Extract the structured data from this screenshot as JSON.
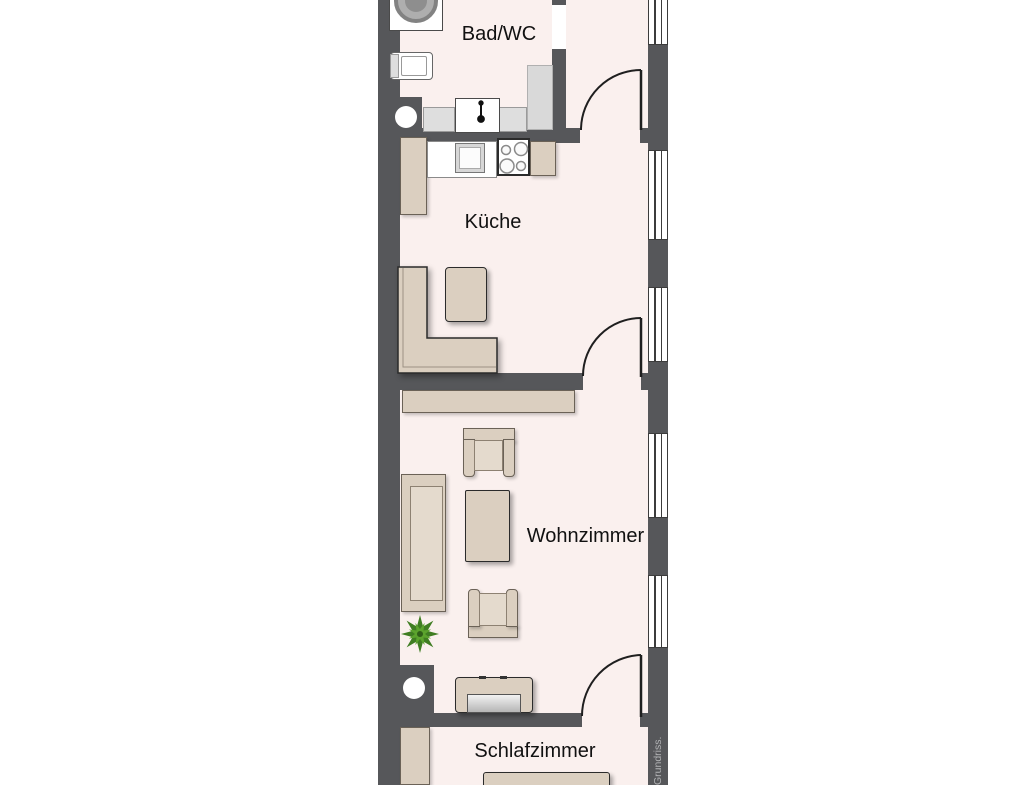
{
  "floorplan": {
    "watermark": "Grundriss.",
    "rooms": [
      {
        "id": "bad-wc",
        "label": "Bad/WC",
        "furniture": [
          "washing-machine",
          "toilet",
          "washbasin-counter",
          "shower"
        ]
      },
      {
        "id": "kueche",
        "label": "Küche",
        "furniture": [
          "tall-cabinet",
          "counter-with-sink",
          "stove",
          "corner-bench",
          "dining-table"
        ]
      },
      {
        "id": "wohnzimmer",
        "label": "Wohnzimmer",
        "furniture": [
          "sideboard",
          "armchair",
          "sofa",
          "coffee-table",
          "armchair",
          "plant",
          "tv-lowboard"
        ]
      },
      {
        "id": "schlafzimmer",
        "label": "Schlafzimmer",
        "furniture": [
          "wardrobe",
          "bed"
        ]
      }
    ],
    "doors": [
      "bad-wc-door",
      "hall-to-kitchen-door",
      "kitchen-to-living-room-door",
      "living-room-to-bedroom-door"
    ],
    "windows_count": 5,
    "colors": {
      "wall": "#56575a",
      "floor": "#faf0ee",
      "furniture_beige": "#dbcfc0",
      "counter_gray": "#dedede",
      "plant_green": "#5ba32d",
      "label_text": "#111111",
      "watermark_text": "#b3b4b6"
    }
  }
}
